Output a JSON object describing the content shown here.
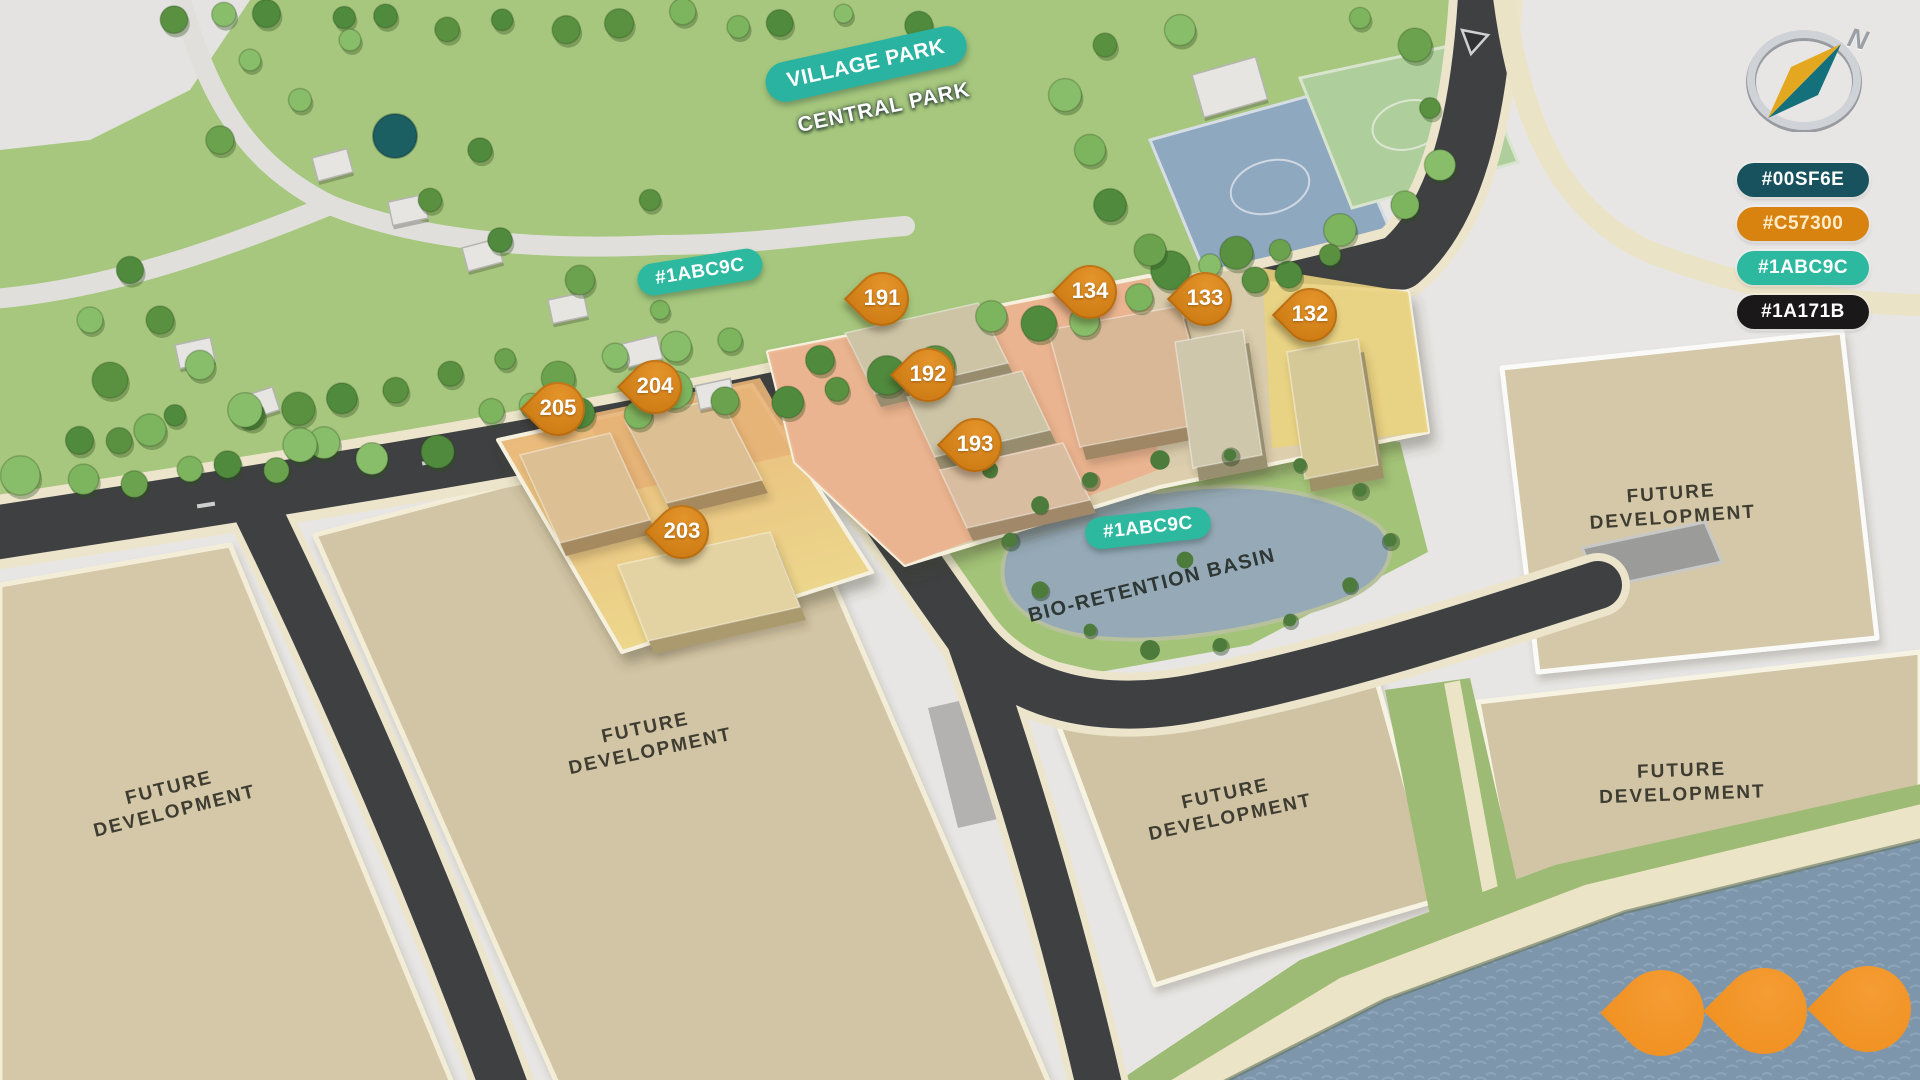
{
  "labels": {
    "village_park": "VILLAGE PARK",
    "central_park": "CENTRAL PARK",
    "basin": "BIO-RETENTION BASIN",
    "road_color_tag": "#1ABC9C",
    "basin_color_tag": "#1ABC9C"
  },
  "parcels": [
    {
      "id": "left",
      "label": "FUTURE DEVELOPMENT"
    },
    {
      "id": "center",
      "label": "FUTURE DEVELOPMENT"
    },
    {
      "id": "top-right",
      "label": "FUTURE DEVELOPMENT"
    },
    {
      "id": "bottom-middle",
      "label": "FUTURE DEVELOPMENT"
    },
    {
      "id": "bottom-right",
      "label": "FUTURE DEVELOPMENT"
    }
  ],
  "pins": [
    {
      "label": "205"
    },
    {
      "label": "204"
    },
    {
      "label": "203"
    },
    {
      "label": "191"
    },
    {
      "label": "192"
    },
    {
      "label": "193"
    },
    {
      "label": "134"
    },
    {
      "label": "133"
    },
    {
      "label": "132"
    }
  ],
  "legend": {
    "items": [
      {
        "label": "#00SF6E",
        "color": "#17525e",
        "text_color": "#ffffff"
      },
      {
        "label": "#C57300",
        "color": "#d8830f",
        "text_color": "#ffeccb"
      },
      {
        "label": "#1ABC9C",
        "color": "#2cb9a0",
        "text_color": "#ffffff"
      },
      {
        "label": "#1A171B",
        "color": "#1b181a",
        "text_color": "#ffffff"
      }
    ]
  },
  "compass": {
    "north": "N"
  },
  "colors": {
    "pin_orange": "#cf7c15",
    "plain_pin_orange": "#f0932a",
    "tag_teal": "#2cb9a0",
    "water": "#7e96ab",
    "park_green": "#a6c77d",
    "parcel_tan": "#d3c6a7",
    "road_dark": "#3e4042"
  }
}
